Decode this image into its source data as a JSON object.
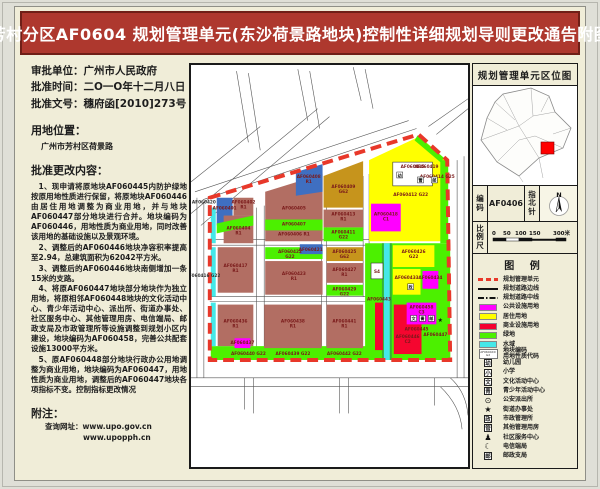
{
  "title": "芳村分区AF0604 规划管理单元(东沙荷景路地块)控制性详细规划导则更改通告附图",
  "left_panel": {
    "approval": [
      {
        "label": "审批单位：",
        "value": "广州市人民政府"
      },
      {
        "label": "批准时间：",
        "value": "二O一O年十二月八日"
      },
      {
        "label": "批准文号：",
        "value": "穗府函[2010]273号"
      }
    ],
    "location_heading": "用地位置：",
    "location": "广州市芳村区荷景路",
    "content_heading": "批准更改内容：",
    "paragraphs": [
      "1、现申请将原地块AF060445内防护绿地按原用地性质进行保留，将原地块AF060446由居住用地调整为商业用地，并与地块AF060447部分地块进行合并。地块编码为AF060446，用地性质为商业用地，同时改善该用地的基础设施以及景观环境。",
      "2、调整后的AF060446地块净容积率提高至2.94，总建筑面积为62042平方米。",
      "3、调整后的AF060446地块南侧增加一条15米的支路。",
      "4、将原AF060447地块部分地块作为独立用地，将原相邻AF060448地块的文化活动中心、青少年活动中心、派出所、街道办事处、社区服务中心、其他管理用房、电信端局、邮政支局及市政管理所等设施调整到规划小区内建设，地块编码为AF060458，完善公共配套设施13000平方米。",
      "5、原AF060448部分地块行政办公用地调整为商业用地，地块编码为AF060447，用地性质为商业用地，调整后的AF060447地块各项指标不变。控制指标更改情况"
    ],
    "note_heading": "附注：",
    "note_label": "查询网址：",
    "urls": [
      "www.upo.gov.cn",
      "www.upopph.cn"
    ]
  },
  "right_panel": {
    "location_map_title": "规划管理单元区位图",
    "code_label": "编码",
    "code_value": "AF0406",
    "compass_label": "指北针",
    "compass_n": "N",
    "scale_label": "比例尺",
    "scale_ticks": [
      "0",
      "50",
      "100",
      "150",
      "300米"
    ],
    "legend_title": "图  例",
    "legend": [
      {
        "type": "dash-red",
        "label": "规划管理单元"
      },
      {
        "type": "line",
        "label": "规划道路边线"
      },
      {
        "type": "dashdot",
        "label": "规划道路中线"
      },
      {
        "type": "fill",
        "color": "#FF00FF",
        "label": "公共设施用地"
      },
      {
        "type": "fill",
        "color": "#FFFF00",
        "label": "居住用地"
      },
      {
        "type": "fill",
        "color": "#F5002F",
        "label": "商业设施用地"
      },
      {
        "type": "fill",
        "color": "#4CF000",
        "label": "绿地"
      },
      {
        "type": "fill",
        "color": "#45E8E8",
        "label": "水域"
      },
      {
        "type": "codebox",
        "box_top": "AF0604XX",
        "box_bottom": "G2",
        "label2": [
          "地块编码",
          "用地性质代码"
        ]
      },
      {
        "type": "boxchar",
        "char": "幼",
        "label": "幼儿园"
      },
      {
        "type": "boxchar",
        "char": "小",
        "label": "小学"
      },
      {
        "type": "boxchar",
        "char": "文",
        "label": "文化活动中心"
      },
      {
        "type": "boxchar",
        "char": "青",
        "label": "青少年活动中心"
      },
      {
        "type": "glyph",
        "char": "⊙",
        "label": "公安派出所"
      },
      {
        "type": "glyph",
        "char": "★",
        "label": "街道办事处"
      },
      {
        "type": "boxchar",
        "char": "政",
        "label": "市政管理所"
      },
      {
        "type": "boxchar",
        "char": "管",
        "label": "其他管理用房"
      },
      {
        "type": "glyph",
        "char": "♟",
        "label": "社区服务中心"
      },
      {
        "type": "glyph",
        "char": "☾",
        "label": "电信端局"
      },
      {
        "type": "boxchar",
        "char": "邮",
        "label": "邮政支局"
      }
    ],
    "location_map": {
      "outline": "30,8 58,2 76,10 82,26 98,42 90,62 66,72 46,90 24,76 8,54 14,32 22,16",
      "inner_paths": [
        "M30,8 L46,40",
        "M8,54 L46,40",
        "M46,40 L66,72",
        "M58,2 L60,30",
        "M82,26 L60,30",
        "M22,16 L42,34",
        "M24,76 L46,54",
        "M90,62 L62,50",
        "M60,30 L46,40",
        "M46,54 L62,50",
        "M66,72 L70,92",
        "M46,90 L50,96",
        "M14,32 L34,44",
        "M76,10 L68,26",
        "M98,42 L80,48"
      ],
      "marker_color": "#FF0000",
      "marker": [
        68,
        56,
        13,
        12
      ]
    }
  },
  "map": {
    "road_color": "#555555",
    "inner_road_color": "#333333",
    "boundary_color": "#E8382A",
    "boundary_pts": "19,134 230,70 259,96 262,298 19,298",
    "label_color": "#7A1A1A",
    "roads": [
      "M0,150 L128,44",
      "M10,162 L140,52",
      "M0,118 L70,62",
      "M4,128 L220,56",
      "M12,136 L228,64",
      "M58,78 L46,6",
      "M70,86 L58,8",
      "M118,56 L108,4",
      "M130,64 L120,6",
      "M172,36 L164,2",
      "M184,44 L176,4",
      "M240,62 L280,34",
      "M248,70 L280,44",
      "M269,96 L269,316",
      "M276,92 L276,316",
      "M6,134 L6,316",
      "M13,138 L13,316",
      "M0,316 L280,316",
      "M0,325 L280,325",
      "M54,316 L54,348",
      "M63,316 L63,352",
      "M150,316 L150,352",
      "M159,316 L159,352",
      "M246,316 L246,344",
      "M262,316 Q278,330 280,354",
      "M252,325 Q272,344 274,368",
      "M19,176 L262,176",
      "M19,182 L262,182",
      "M19,234 L262,234",
      "M19,239 L262,239",
      "M66,144 L66,286",
      "M74,142 L74,286",
      "M132,120 L132,286",
      "M137,118 L137,286",
      "M174,112 L174,234",
      "M180,110 L180,234"
    ],
    "colors": {
      "residential_brown": "#B26E63",
      "blue": "#3F6FC1",
      "mustard": "#C6941C",
      "yellow": "#FFFF00",
      "green": "#4CF000",
      "cyan": "#45E8E8",
      "magenta": "#FF00FF",
      "red": "#F5062F"
    },
    "parcels": [
      {
        "f": "#4CF000",
        "r": [
          176,
          180,
          86,
          118
        ]
      },
      {
        "f": "#4CF000",
        "r": [
          20,
          284,
          242,
          14
        ]
      },
      {
        "f": "#FFFF00",
        "pts": "180,96 231,72 258,96 260,178 180,178"
      },
      {
        "f": "#4CF000",
        "r": [
          252,
          96,
          8,
          84
        ]
      },
      {
        "f": "#4CF000",
        "pts": "229,71 256,94 252,98 226,76"
      },
      {
        "f": "#C6941C",
        "c": "AF060409",
        "u": "G62",
        "pts": "134,112 174,97 174,144 134,144",
        "lx": 154,
        "ly": 124
      },
      {
        "f": "#B26E63",
        "c": "AF060405",
        "pts": "75,128 133,110 133,178 75,178",
        "lx": 104,
        "ly": 146
      },
      {
        "f": "#3F6FC1",
        "c": "AF060408",
        "u": "R1",
        "pts": "106,108 133,100 133,128 106,132",
        "lx": 119,
        "ly": 114
      },
      {
        "f": "#4CF000",
        "c": "AF060407",
        "r": [
          75,
          156,
          58,
          11
        ],
        "lx": 104,
        "ly": 162
      },
      {
        "f": "#B26E63",
        "c": "AF060413",
        "u": "R1",
        "r": [
          134,
          146,
          40,
          18
        ],
        "lx": 154,
        "ly": 152
      },
      {
        "f": "#4CF000",
        "c": "AF060411",
        "u": "G22",
        "r": [
          134,
          164,
          40,
          14
        ],
        "lx": 154,
        "ly": 170
      },
      {
        "f": "#45E8E8",
        "r": [
          20,
          144,
          5,
          36
        ]
      },
      {
        "f": "#3F6FC1",
        "c": "AF060401",
        "r": [
          26,
          134,
          16,
          28
        ],
        "lx": 34,
        "ly": 146
      },
      {
        "f": "#B26E63",
        "c": "AF060402",
        "u": "R1",
        "r": [
          43,
          134,
          20,
          18
        ],
        "lx": 53,
        "ly": 140
      },
      {
        "f": "#B26E63",
        "c": "AF060404",
        "u": "R1",
        "r": [
          33,
          152,
          30,
          28
        ],
        "lx": 48,
        "ly": 166
      },
      {
        "f": "#4CF000",
        "pts": "26,160 63,152 63,162 26,170"
      },
      {
        "f": "#FF00FF",
        "c": "AF060418",
        "u": "C1",
        "r": [
          182,
          140,
          30,
          28
        ],
        "lx": 197,
        "ly": 152
      },
      {
        "f": "#FFFFFF",
        "c": "AF060415",
        "r": [
          204,
          98,
          40,
          24
        ],
        "s": 1,
        "lx": 224,
        "ly": 104
      },
      {
        "f": "#45E8E8",
        "r": [
          20,
          184,
          5,
          50
        ]
      },
      {
        "f": "#B26E63",
        "c": "AF060417",
        "u": "R1",
        "r": [
          27,
          184,
          36,
          46
        ],
        "lx": 45,
        "ly": 204
      },
      {
        "f": "#4CF000",
        "c": "AF060422",
        "u": "G22",
        "r": [
          75,
          184,
          58,
          12
        ],
        "lx": 100,
        "ly": 190
      },
      {
        "f": "#3F6FC1",
        "c": "AF060421",
        "r": [
          110,
          181,
          23,
          10
        ],
        "lx": 121,
        "ly": 188
      },
      {
        "f": "#B26E63",
        "c": "AF060423",
        "u": "R1",
        "r": [
          75,
          198,
          58,
          34
        ],
        "lx": 104,
        "ly": 212
      },
      {
        "f": "#C6941C",
        "c": "AF060425",
        "u": "G62",
        "r": [
          137,
          184,
          37,
          14
        ],
        "lx": 155,
        "ly": 190
      },
      {
        "f": "#B26E63",
        "c": "AF060427",
        "u": "R1",
        "r": [
          137,
          200,
          37,
          20
        ],
        "lx": 155,
        "ly": 208
      },
      {
        "f": "#4CF000",
        "c": "AF060429",
        "u": "G22",
        "r": [
          137,
          222,
          37,
          11
        ],
        "lx": 155,
        "ly": 228
      },
      {
        "f": "#35B235",
        "r": [
          193,
          180,
          2,
          118
        ]
      },
      {
        "f": "#45E8E8",
        "r": [
          195,
          180,
          6,
          118
        ]
      },
      {
        "f": "#35B235",
        "r": [
          201,
          180,
          2,
          118
        ]
      },
      {
        "f": "#FFFFFF",
        "c": "S4",
        "r": [
          182,
          200,
          12,
          16
        ],
        "s": 1,
        "lx": 188,
        "ly": 210
      },
      {
        "f": "#FFFF00",
        "c": "AF060426",
        "u": "G22",
        "r": [
          204,
          182,
          42,
          22
        ],
        "lx": 225,
        "ly": 190
      },
      {
        "f": "#FFFF00",
        "c": "AF060433",
        "r": [
          204,
          206,
          28,
          26
        ],
        "lx": 218,
        "ly": 216
      },
      {
        "f": "#FF00FF",
        "c": "AF060434",
        "r": [
          234,
          208,
          16,
          18
        ],
        "lx": 242,
        "ly": 216
      },
      {
        "f": "#45E8E8",
        "r": [
          20,
          240,
          5,
          44
        ]
      },
      {
        "f": "#B26E63",
        "c": "AF060436",
        "u": "R1",
        "r": [
          27,
          242,
          36,
          42
        ],
        "lx": 45,
        "ly": 260
      },
      {
        "f": "#FF00FF",
        "c": "AF060437",
        "r": [
          44,
          276,
          16,
          10
        ],
        "lx": 52,
        "ly": 282
      },
      {
        "f": "#B26E63",
        "c": "AF060438",
        "u": "R1",
        "r": [
          74,
          242,
          58,
          44
        ],
        "lx": 103,
        "ly": 260
      },
      {
        "f": "#B26E63",
        "c": "AF060441",
        "u": "R1",
        "r": [
          137,
          242,
          37,
          44
        ],
        "lx": 155,
        "ly": 260
      },
      {
        "f": "#F5062F",
        "r": [
          186,
          240,
          8,
          48
        ]
      },
      {
        "f": "#F5062F",
        "c": "AF060446",
        "u": "C2",
        "r": [
          205,
          242,
          28,
          50
        ],
        "lx": 219,
        "ly": 276
      },
      {
        "f": "#FF00FF",
        "c": "AF060458",
        "u": "C3",
        "r": [
          218,
          240,
          30,
          22
        ],
        "lx": 233,
        "ly": 246
      }
    ],
    "loose_labels": [
      {
        "t": "AF060406 R1",
        "x": 104,
        "y": 172
      },
      {
        "t": "AF060420",
        "x": 13,
        "y": 140,
        "c": "#333333"
      },
      {
        "t": "AF060416 G22",
        "x": 12,
        "y": 214,
        "c": "#333333"
      },
      {
        "t": "AF060414 G25",
        "x": 249,
        "y": 114
      },
      {
        "t": "AF060412 G22",
        "x": 222,
        "y": 132
      },
      {
        "t": "AF060419",
        "x": 238,
        "y": 104
      },
      {
        "t": "AF060439 G22",
        "x": 103,
        "y": 293
      },
      {
        "t": "AF060442 G22",
        "x": 155,
        "y": 293
      },
      {
        "t": "AF060440 G22",
        "x": 58,
        "y": 293
      },
      {
        "t": "AF060443",
        "x": 190,
        "y": 238
      },
      {
        "t": "AF060445",
        "x": 228,
        "y": 268
      },
      {
        "t": "AF060447",
        "x": 247,
        "y": 274
      }
    ],
    "symbols": [
      {
        "g": "幼",
        "x": 211,
        "y": 111
      },
      {
        "g": "管",
        "x": 232,
        "y": 116
      },
      {
        "g": "邮",
        "x": 246,
        "y": 116
      },
      {
        "g": "政",
        "x": 222,
        "y": 224
      },
      {
        "g": "文",
        "x": 225,
        "y": 256
      },
      {
        "g": "青",
        "x": 234,
        "y": 256
      },
      {
        "g": "邮",
        "x": 243,
        "y": 256
      },
      {
        "g": "★",
        "x": 252,
        "y": 258,
        "plain": 1
      }
    ]
  }
}
